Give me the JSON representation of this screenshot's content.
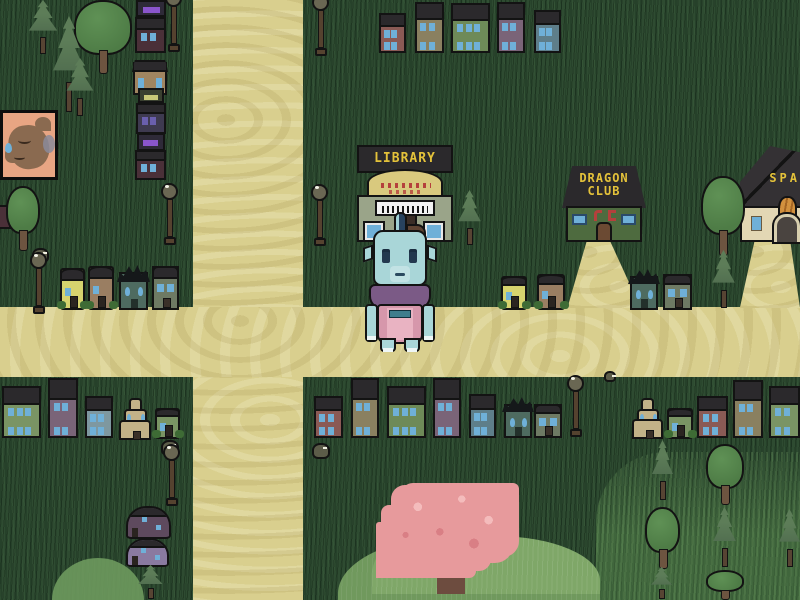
{
  "scene_name": "village-overworld",
  "buildings": {
    "library": {
      "sign": "LIBRARY"
    },
    "dragon_club": {
      "sign_line1": "DRAGON",
      "sign_line2": "CLUB"
    },
    "spa": {
      "sign": "SPA"
    }
  },
  "palette": {
    "grass": "#2a452e",
    "path": "#d9cf8e",
    "roof": "#2b292c",
    "ink": "#131313",
    "sign-yellow": "#e4c23a",
    "sign-red": "#b5403c",
    "window": "#6fb0d8",
    "library-wall": "#9aa489",
    "library-arch": "#d9c97e",
    "club-wall": "#4e6b3f",
    "spa-wall": "#e3d7b4",
    "spa-cat": "#d2913e",
    "door": "#6b4a33",
    "lamp-pole": "#55422f",
    "lamp-globe": "#6a6753",
    "char-skin": "#a9d6d8",
    "char-crest": "#27425e",
    "char-hair": "#5e4332",
    "char-shawl": "#7b5a86",
    "char-dress": "#d697ab",
    "char-bib": "#e9b3c2",
    "char-belt": "#3f7d8c",
    "pine": "#5d7d58",
    "pine-dark": "#49644a",
    "tree": "#55854c",
    "trunk": "#6d5440",
    "hill": "#7fa768",
    "cherry": "#e79a9c",
    "cherry-trunk": "#6d4c3f",
    "rock": "#5c5c49",
    "portrait-bg": "#e8a583",
    "portrait-fur": "#8a6a50"
  },
  "houses": [
    {
      "style": "rowhouse",
      "x": 379,
      "y": 13,
      "w": 27,
      "h": 40,
      "body": "#8a5a55"
    },
    {
      "style": "rowhouse",
      "x": 415,
      "y": 2,
      "w": 29,
      "h": 51,
      "body": "#8a8060"
    },
    {
      "style": "rowhouse",
      "x": 451,
      "y": 3,
      "w": 39,
      "h": 50,
      "body": "#6e8a58"
    },
    {
      "style": "rowhouse",
      "x": 497,
      "y": 2,
      "w": 28,
      "h": 51,
      "body": "#7a6478"
    },
    {
      "style": "rowhouse",
      "x": 534,
      "y": 10,
      "w": 27,
      "h": 43,
      "body": "#5e7e8a"
    },
    {
      "style": "village",
      "x": 136,
      "y": 0,
      "w": 30,
      "h": 17,
      "body": "#2e2a38",
      "win": "#8a55cc"
    },
    {
      "style": "rowhouse",
      "x": 135,
      "y": 17,
      "w": 31,
      "h": 36,
      "body": "#4a3038"
    },
    {
      "style": "cottage",
      "x": 133,
      "y": 62,
      "w": 34,
      "h": 33,
      "body": "#a08560"
    },
    {
      "style": "village",
      "x": 138,
      "y": 88,
      "w": 26,
      "h": 15,
      "body": "#3a4030",
      "win": "#c8c878"
    },
    {
      "style": "rowhouse",
      "x": 136,
      "y": 103,
      "w": 30,
      "h": 31,
      "body": "#3e3a50",
      "win": "#6a5fae"
    },
    {
      "style": "village",
      "x": 137,
      "y": 133,
      "w": 28,
      "h": 18,
      "body": "#2e2a38",
      "win": "#8a55cc"
    },
    {
      "style": "rowhouse",
      "x": 135,
      "y": 150,
      "w": 31,
      "h": 30,
      "body": "#4a3038"
    },
    {
      "style": "small",
      "x": 60,
      "y": 268,
      "w": 25,
      "h": 42,
      "body": "#d6d36e",
      "bush": true
    },
    {
      "style": "small",
      "x": 88,
      "y": 266,
      "w": 26,
      "h": 44,
      "body": "#9a7e62",
      "bush": true
    },
    {
      "style": "spiky",
      "x": 119,
      "y": 272,
      "w": 29,
      "h": 38,
      "body": "#4e6b60"
    },
    {
      "style": "graysmall",
      "x": 152,
      "y": 266,
      "w": 27,
      "h": 44,
      "body": "#6e7a64"
    },
    {
      "style": "small",
      "x": 501,
      "y": 276,
      "w": 26,
      "h": 34,
      "body": "#d6d36e",
      "bush": true
    },
    {
      "style": "small",
      "x": 537,
      "y": 274,
      "w": 28,
      "h": 36,
      "body": "#9a7e62",
      "bush": true
    },
    {
      "style": "spiky",
      "x": 630,
      "y": 276,
      "w": 28,
      "h": 34,
      "body": "#4e6b60"
    },
    {
      "style": "graysmall",
      "x": 663,
      "y": 274,
      "w": 29,
      "h": 36,
      "body": "#6e7a64"
    },
    {
      "style": "rowhouse",
      "x": 2,
      "y": 386,
      "w": 39,
      "h": 52,
      "body": "#7a9464"
    },
    {
      "style": "rowhouse",
      "x": 48,
      "y": 378,
      "w": 30,
      "h": 60,
      "body": "#7a6478"
    },
    {
      "style": "rowhouse",
      "x": 85,
      "y": 396,
      "w": 28,
      "h": 42,
      "body": "#7e98a0"
    },
    {
      "style": "pagoda",
      "x": 119,
      "y": 398,
      "w": 32,
      "h": 42,
      "body": "#c2b288"
    },
    {
      "style": "small",
      "x": 155,
      "y": 408,
      "w": 25,
      "h": 31,
      "body": "#7a9464",
      "bush": true
    },
    {
      "style": "rowhouse",
      "x": 314,
      "y": 396,
      "w": 29,
      "h": 42,
      "body": "#8a5a55"
    },
    {
      "style": "rowhouse",
      "x": 351,
      "y": 378,
      "w": 28,
      "h": 60,
      "body": "#8a8060"
    },
    {
      "style": "rowhouse",
      "x": 387,
      "y": 386,
      "w": 39,
      "h": 52,
      "body": "#6e8a58"
    },
    {
      "style": "rowhouse",
      "x": 433,
      "y": 378,
      "w": 28,
      "h": 60,
      "body": "#7a6478"
    },
    {
      "style": "rowhouse",
      "x": 469,
      "y": 394,
      "w": 27,
      "h": 44,
      "body": "#5e7e8a"
    },
    {
      "style": "spiky",
      "x": 504,
      "y": 404,
      "w": 28,
      "h": 34,
      "body": "#4e6b60"
    },
    {
      "style": "graysmall",
      "x": 534,
      "y": 404,
      "w": 28,
      "h": 34,
      "body": "#6e7a64"
    },
    {
      "style": "pagoda",
      "x": 632,
      "y": 398,
      "w": 31,
      "h": 41,
      "body": "#c2b288"
    },
    {
      "style": "small",
      "x": 667,
      "y": 408,
      "w": 26,
      "h": 31,
      "body": "#7a9464",
      "bush": true
    },
    {
      "style": "rowhouse",
      "x": 697,
      "y": 396,
      "w": 31,
      "h": 42,
      "body": "#8a5a55"
    },
    {
      "style": "rowhouse",
      "x": 733,
      "y": 380,
      "w": 30,
      "h": 58,
      "body": "#8a8060"
    },
    {
      "style": "rowhouse",
      "x": 769,
      "y": 386,
      "w": 31,
      "h": 52,
      "body": "#7a9464"
    },
    {
      "style": "mushroom",
      "x": 126,
      "y": 506,
      "w": 45,
      "h": 33,
      "body": "#5e4a5e"
    },
    {
      "style": "mushroom",
      "x": 126,
      "y": 538,
      "w": 43,
      "h": 29,
      "body": "#8a7aa0"
    }
  ],
  "trees": [
    {
      "kind": "pine",
      "x": 26,
      "y": 0,
      "w": 34,
      "h": 56
    },
    {
      "kind": "round",
      "x": 74,
      "y": 0,
      "w": 58,
      "h": 76
    },
    {
      "kind": "pine",
      "x": 50,
      "y": 16,
      "w": 38,
      "h": 100
    },
    {
      "kind": "pine",
      "x": 64,
      "y": 58,
      "w": 32,
      "h": 60
    },
    {
      "kind": "round",
      "x": 6,
      "y": 186,
      "w": 34,
      "h": 66
    },
    {
      "kind": "pine",
      "x": 456,
      "y": 190,
      "w": 27,
      "h": 58
    },
    {
      "kind": "round",
      "x": 701,
      "y": 176,
      "w": 44,
      "h": 82
    },
    {
      "kind": "pine",
      "x": 710,
      "y": 250,
      "w": 27,
      "h": 60
    },
    {
      "kind": "pine",
      "x": 650,
      "y": 440,
      "w": 25,
      "h": 62
    },
    {
      "kind": "round",
      "x": 706,
      "y": 444,
      "w": 38,
      "h": 62
    },
    {
      "kind": "round",
      "x": 645,
      "y": 507,
      "w": 35,
      "h": 64
    },
    {
      "kind": "pine",
      "x": 711,
      "y": 507,
      "w": 27,
      "h": 62
    },
    {
      "kind": "pine",
      "x": 777,
      "y": 509,
      "w": 25,
      "h": 60
    },
    {
      "kind": "pine",
      "x": 649,
      "y": 567,
      "w": 25,
      "h": 33
    },
    {
      "kind": "round",
      "x": 706,
      "y": 570,
      "w": 38,
      "h": 30
    },
    {
      "kind": "pine",
      "x": 136,
      "y": 565,
      "w": 29,
      "h": 35
    }
  ],
  "lamps": [
    {
      "x": 164,
      "y": -10
    },
    {
      "x": 311,
      "y": -6
    },
    {
      "x": 160,
      "y": 183
    },
    {
      "x": 310,
      "y": 184
    },
    {
      "x": 29,
      "y": 252
    },
    {
      "x": 566,
      "y": 375
    },
    {
      "x": 162,
      "y": 444
    }
  ],
  "rocks": [
    {
      "x": 32,
      "y": 248,
      "w": 17,
      "h": 15
    },
    {
      "x": 161,
      "y": 440,
      "w": 18,
      "h": 16
    },
    {
      "x": 312,
      "y": 443,
      "w": 18,
      "h": 16
    },
    {
      "x": 604,
      "y": 371,
      "w": 12,
      "h": 11
    }
  ]
}
